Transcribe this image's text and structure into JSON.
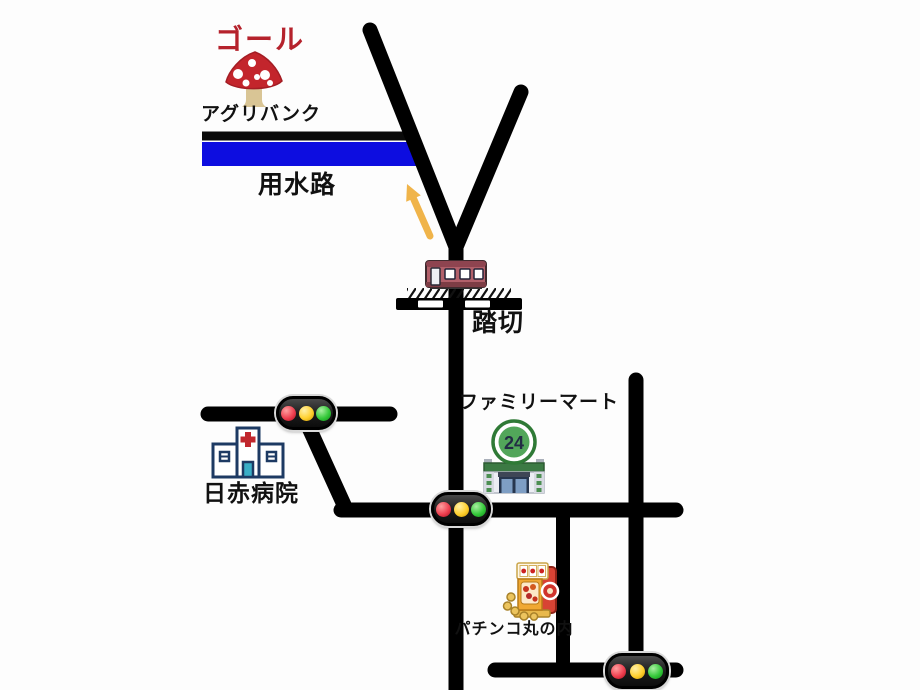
{
  "map": {
    "background_color": "#fdfdfd",
    "road_color": "#000000",
    "labels": {
      "goal": "ゴール",
      "agri_bank": "アグリバンク",
      "water_channel": "用水路",
      "railroad_crossing": "踏切",
      "familymart": "ファミリーマート",
      "hospital": "日赤病院",
      "pachinko": "パチンコ丸の内"
    },
    "store_sign_text": "24",
    "colors": {
      "goal_text": "#b5222c",
      "water_channel_blue": "#0d0de0",
      "arrow_orange": "#f0b44a",
      "traffic_light_red": "#ef4050",
      "traffic_light_yellow": "#ffd02e",
      "traffic_light_green": "#35c93a",
      "mushroom_cap_red": "#c3252c",
      "train_body": "#b2606a",
      "hospital_outline_navy": "#1d3a63",
      "store_sign_green": "#47a04e",
      "slot_machine_red": "#d84334"
    },
    "icons": [
      "mushroom-icon",
      "up-arrow-icon",
      "train-icon",
      "railroad-crossing-bar-icon",
      "traffic-light-icon",
      "hospital-icon",
      "convenience-store-icon",
      "slot-machine-icon"
    ]
  }
}
